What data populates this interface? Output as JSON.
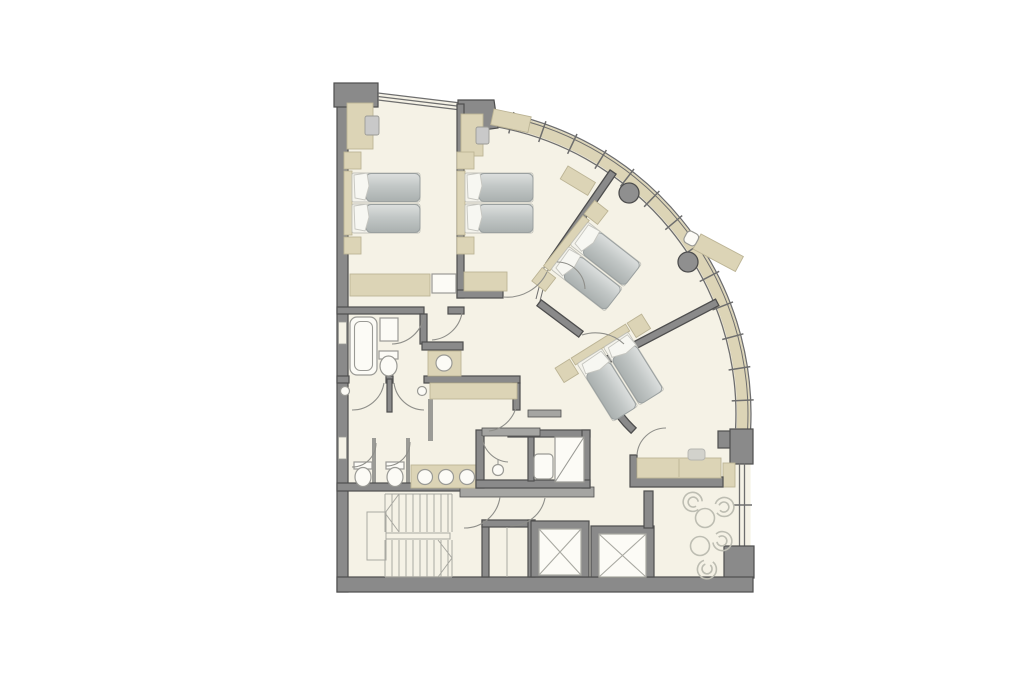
{
  "plan": {
    "description": "Architectural floor plan of a curved corner hotel floor: four twin-bed guest rooms (two orthogonal, two angled along a curved glazed facade), en-suite bathroom, shared WC cubicles with triple-basin vanity, shower room, stair core, service shaft, two elevators and a lounge seating corner.",
    "bedrooms": 4,
    "beds_per_bedroom": 2,
    "bedroom_furniture": [
      "headboard",
      "nightstands",
      "desk",
      "tv",
      "wardrobe",
      "luggage-rack"
    ],
    "bathroom_fixtures": [
      "bathtub",
      "toilet",
      "washbasin"
    ],
    "wc_area_fixtures": [
      "2 wc cubicles",
      "2 wall basins",
      "3-basin vanity"
    ],
    "shower_room_fixtures": [
      "shower",
      "wc",
      "washbasin"
    ],
    "stair_flights": 2,
    "elevators": 2,
    "service_shafts": 1,
    "lounge_fan_chairs": 4,
    "lounge_round_tables": 2,
    "structural_columns": 2,
    "curtain_wall_mullions": 13
  },
  "colors": {
    "background": "#ffffff",
    "floor": "#f5f2e6",
    "wall": "#8a8a8a",
    "wall_outline": "#4e4e4e",
    "partition": "#9b9b96",
    "accent_tan": "#dcd4b6",
    "furniture_outline": "#bcb495",
    "glass_line": "#6e6e6e",
    "fixture_fill": "#fcfbf6",
    "fixture_line": "#9a9a95",
    "duvet_light": "#dcdfde",
    "duvet_dark": "#aab0af",
    "duvet_outline": "#9aa0a0",
    "pillow": "#f7f7f2",
    "teal": "#c9e3da",
    "door_line": "#8f8f8a",
    "stair_line": "#a9a9a2",
    "chair_outline": "#bdbdb2",
    "elevator_line": "#a9a9a2",
    "lintel": "#a5a5a2",
    "tv": "#c9c9c9"
  }
}
